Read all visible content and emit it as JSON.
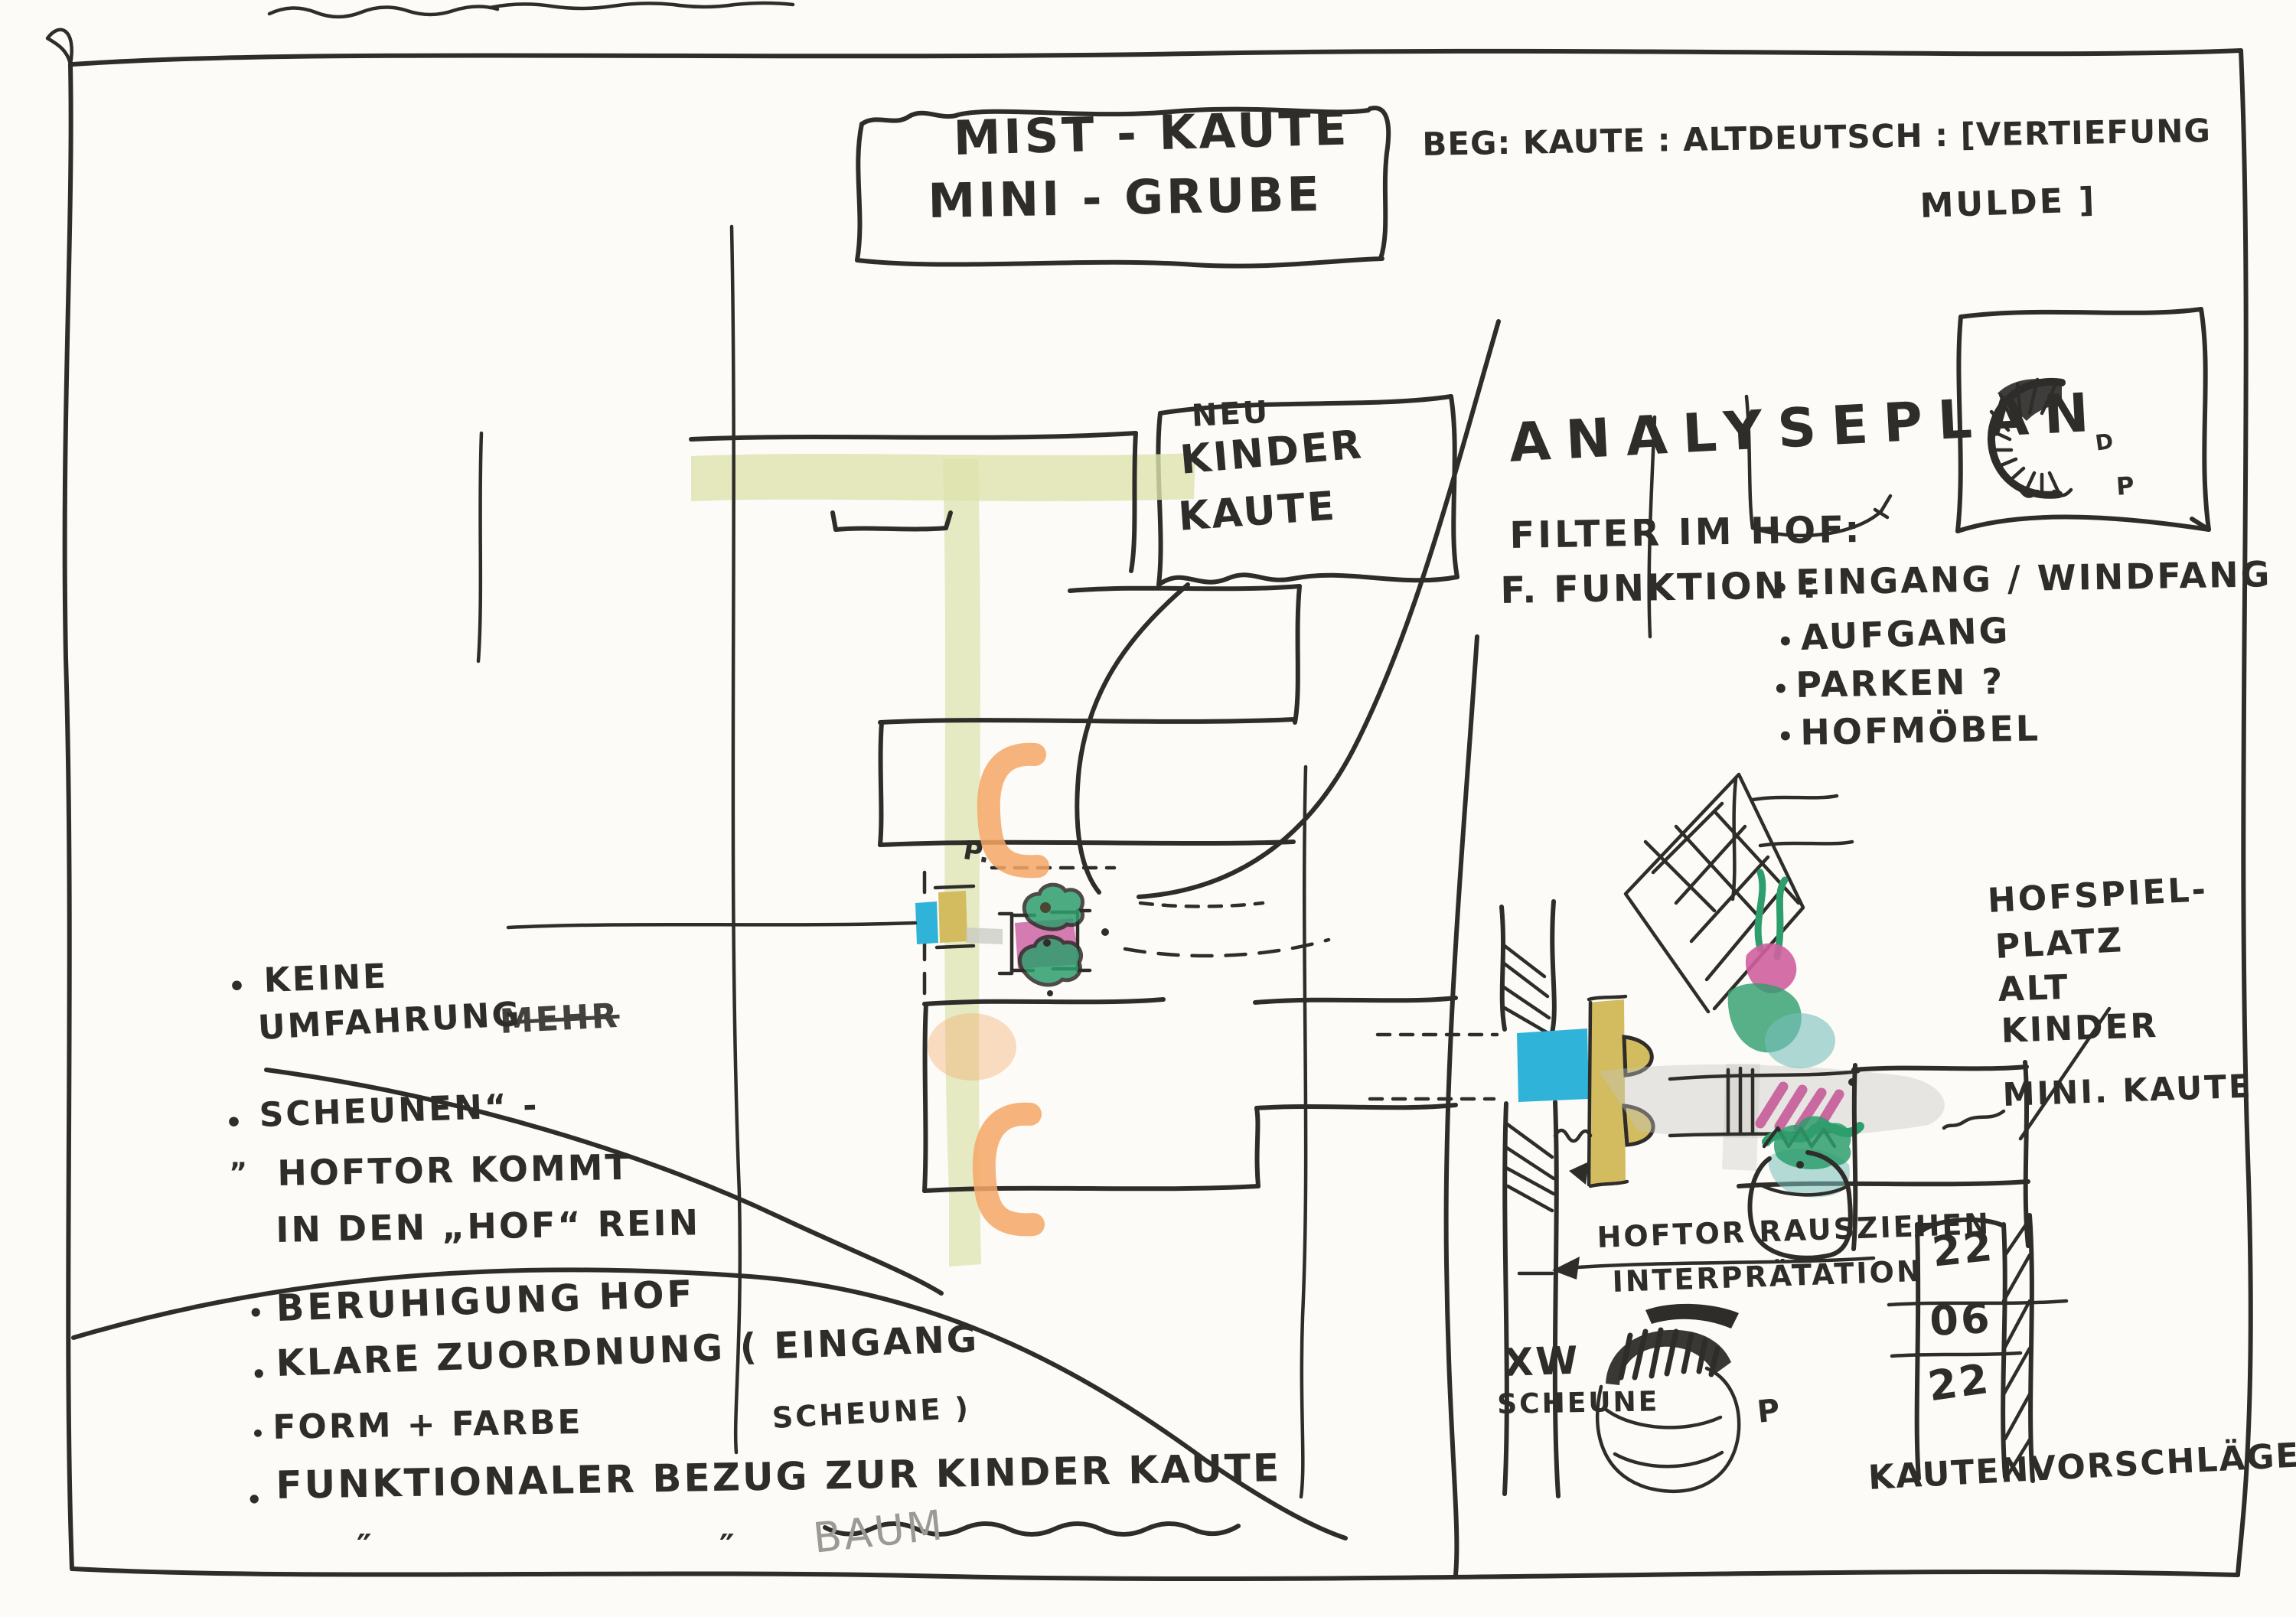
{
  "doc": {
    "title_box": {
      "line1": "MIST - KAUTE",
      "line2": "MINI - GRUBE"
    },
    "definition": {
      "line1": "BEG: KAUTE : ALTDEUTSCH : [VERTIEFUNG",
      "line2": "MULDE ]"
    },
    "neu_box": {
      "line1": "NEU",
      "line2": "KINDER",
      "line3": "KAUTE"
    },
    "analysis": {
      "title": "ANALYSEPLAN",
      "subtitle": "FILTER IM HOF:",
      "function_label": "F. FUNKTION :",
      "bullet": "•",
      "item1": "EINGANG / WINDFANG",
      "item2": "AUFGANG",
      "item3": "PARKEN ?",
      "item4": "HOFMÖBEL"
    },
    "notes": {
      "bullet": "•",
      "ditto": "″",
      "n1_line1": "KEINE",
      "n1_line2": "UMFAHRUNG",
      "n1_struck": "MEHR",
      "n2_quote": "„",
      "n2_line1": "SCHEUNEN“ -",
      "n2_line2": "HOFTOR KOMMT",
      "n2_line3": "IN DEN „HOF“ REIN",
      "n3": "BERUHIGUNG HOF",
      "n4_line1": "KLARE ZUORDNUNG ( EINGANG",
      "n4_line2": "SCHEUNE )",
      "n5": "FORM + FARBE",
      "n6": "FUNKTIONALER BEZUG ZUR KINDER KAUTE",
      "n6_pencil": "BAUM"
    },
    "center_plan": {
      "p_label": "P."
    },
    "corner_sketch": {
      "letter1": "D",
      "letter2": "P"
    },
    "right_plan": {
      "hofspiel_line1": "HOFSPIEL-",
      "hofspiel_line2": "PLATZ",
      "hofspiel_line3": "ALT",
      "hofspiel_line4": "KINDER",
      "mini_kaute": "MINI. KAUTE",
      "hoftor_line1": "HOFTOR RAUSZIEHEN",
      "hoftor_line2": "INTERPRÄTATION",
      "xw": "XW",
      "scheune": "SCHEUNE",
      "p_label": "P",
      "date_day": "22",
      "date_month": "06",
      "date_year": "22",
      "bottom_note": "KAUTENVORSCHLÄGE"
    }
  },
  "colors": {
    "ink": "#2f2d2a",
    "street_olive": "#dde3ac",
    "orange": "#f4a766",
    "cyan": "#2fb3d8",
    "gate_yellow": "#d2bc5f",
    "pink": "#cf6ea8",
    "green": "#2e9e6d",
    "teal": "#76c0ba",
    "gray_wash": "#c6c6c0",
    "pencil": "#9b9b95"
  }
}
